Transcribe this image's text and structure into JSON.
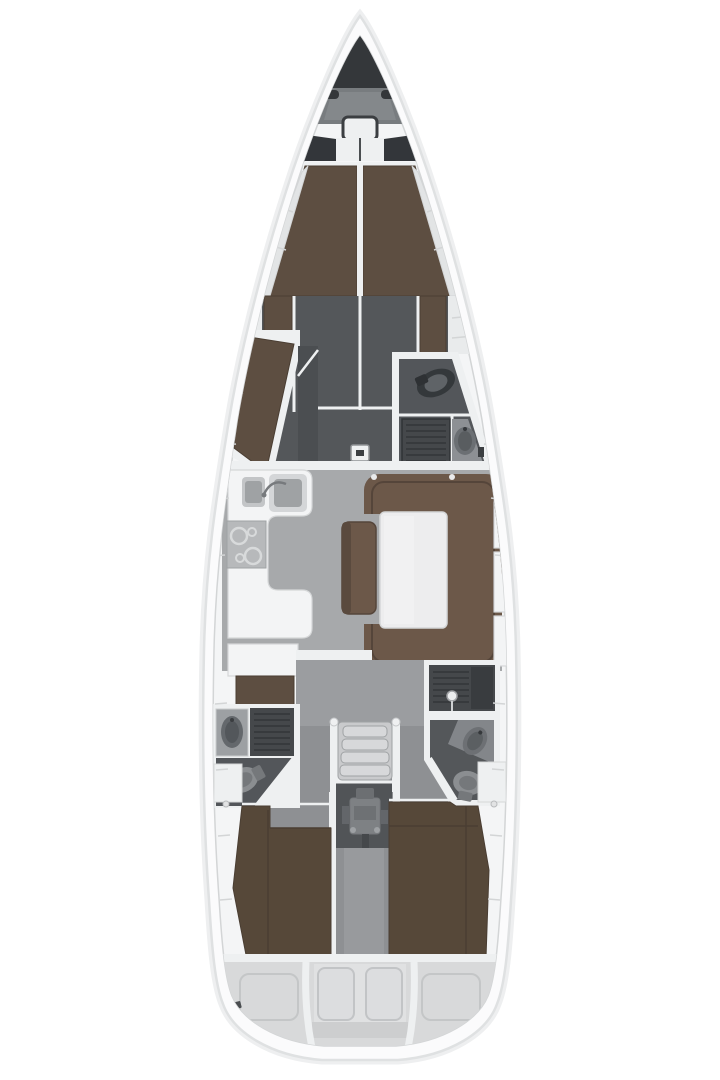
{
  "figure": {
    "type": "yacht-interior-floorplan",
    "orientation": "bow-up"
  },
  "areas": {
    "anchor_locker": "anchor-locker",
    "foredeck_hatch": "foredeck-hatch",
    "v_berth": "forward-v-berth",
    "forward_sofa": "forward-cabin-berth",
    "forward_head": "forward-head-wc-shower",
    "galley": "galley",
    "dinette": "salon-dinette-table",
    "companionway": "companionway-steps",
    "engine": "engine-compartment",
    "aft_head_port": "aft-head-port",
    "aft_head_starboard": "aft-head-starboard",
    "aft_cabin_port": "aft-cabin-port-berth",
    "aft_cabin_starboard": "aft-cabin-starboard-berth",
    "transom": "transom-lockers"
  },
  "colors": {
    "background": "#ffffff",
    "hull_fill": "#fbfbfc",
    "hull_outline": "#dfe1e2",
    "hull_shadow": "#eeeff0",
    "deck_fill": "#f4f5f6",
    "deck_line": "#d3d5d6",
    "trim_white": "#eef0f1",
    "anchor_dark": "#34373a",
    "foredeck_gray": "#787c7f",
    "wall_dark": "#54575a",
    "floor_light": "#a7a9ab",
    "floor_mid": "#9b9da0",
    "floor_cabin": "#8e9093",
    "berth_brown": "#5d4e41",
    "berth_brown_deep": "#564839",
    "berth_seam": "#4a3e33",
    "sofa_brown": "#6c5849",
    "sofa_seam": "#55453a",
    "furniture_white": "#f3f4f5",
    "furniture_line": "#d5d7d8",
    "steel": "#c3c5c7",
    "steel_dark": "#9fa2a4",
    "stove_gray": "#b7b9bb",
    "fixture_light": "#8b8e91",
    "fixture_mid": "#75787b",
    "fixture_dark": "#3e4144",
    "grate_dark": "#45484b",
    "grate_line": "#333639",
    "steps_fill": "#c9cacc",
    "step_face": "#d7d8da",
    "engine_room": "#515457",
    "engine_body": "#7e8184",
    "transom_gray": "#d8d9da",
    "transom_light": "#e0e1e2",
    "panel_line": "#c4c6c7",
    "table_white": "#ededee"
  }
}
